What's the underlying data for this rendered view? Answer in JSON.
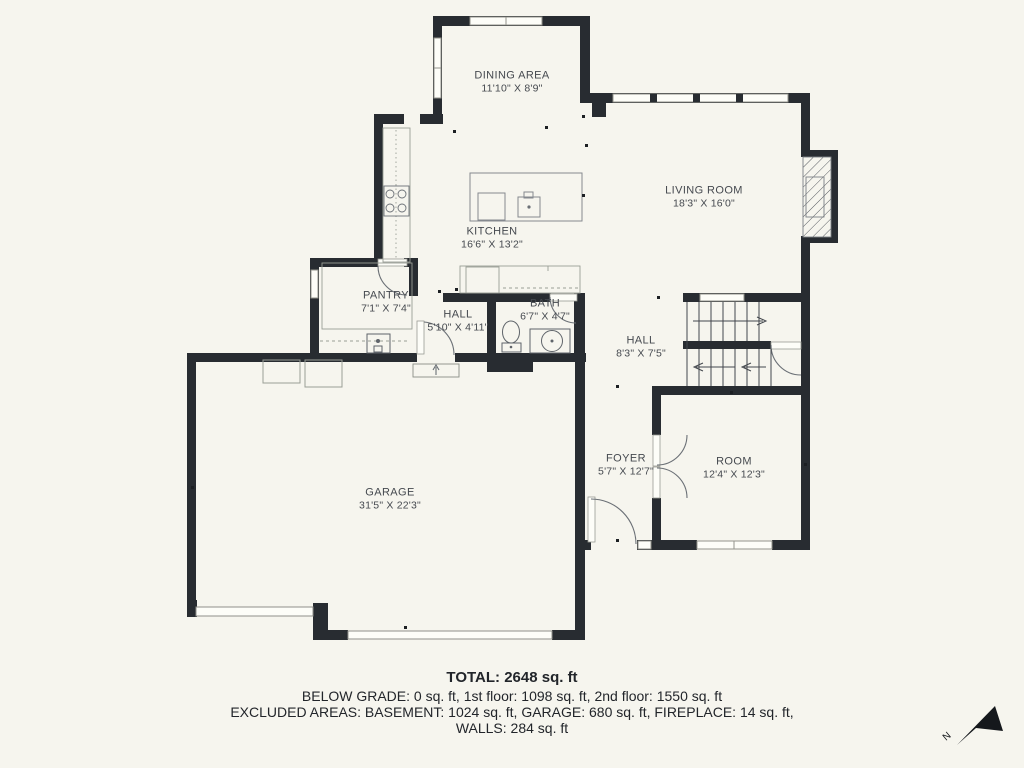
{
  "plan": {
    "background": "#f6f5ee",
    "wall_color": "#282c31",
    "rooms": {
      "dining": {
        "name": "DINING AREA",
        "dims": "11'10\" X 8'9\""
      },
      "living": {
        "name": "LIVING ROOM",
        "dims": "18'3\" X 16'0\""
      },
      "kitchen": {
        "name": "KITCHEN",
        "dims": "16'6\" X 13'2\""
      },
      "pantry": {
        "name": "PANTRY",
        "dims": "7'1\" X 7'4\""
      },
      "hall_small": {
        "name": "HALL",
        "dims": "5'10\" X 4'11\""
      },
      "bath": {
        "name": "BATH",
        "dims": "6'7\" X 4'7\""
      },
      "hall_upper": {
        "name": "HALL",
        "dims": "8'3\" X 7'5\""
      },
      "garage": {
        "name": "GARAGE",
        "dims": "31'5\" X 22'3\""
      },
      "foyer": {
        "name": "FOYER",
        "dims": "5'7\" X 12'7\""
      },
      "room": {
        "name": "ROOM",
        "dims": "12'4\" X 12'3\""
      }
    }
  },
  "footer": {
    "total": "TOTAL: 2648 sq. ft",
    "line2": "BELOW GRADE: 0 sq. ft, 1st floor: 1098 sq. ft, 2nd floor: 1550 sq. ft",
    "line3": "EXCLUDED AREAS: BASEMENT: 1024 sq. ft, GARAGE: 680 sq. ft, FIREPLACE: 14 sq. ft,",
    "line4": "WALLS: 284 sq. ft"
  },
  "compass": {
    "label": "N"
  }
}
